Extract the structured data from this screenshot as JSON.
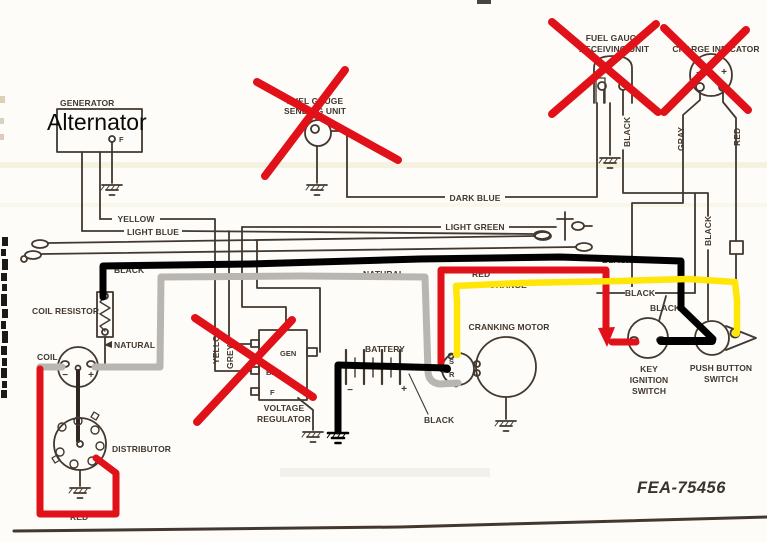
{
  "overlay_annotations": {
    "alternator_text": "Alternator",
    "cross_out_color": "#e01118",
    "wire_black": "#000000",
    "wire_red": "#e01118",
    "wire_yellow": "#ffe606",
    "wire_gray": "#b9b6b2"
  },
  "diagram": {
    "part_number": "FEA-75456",
    "ink_color": "#42382f",
    "components": {
      "generator": {
        "label": "GENERATOR",
        "terminal_f": "F"
      },
      "fuel_gauge_sending_unit": {
        "line1": "FUEL GAUGE",
        "line2": "SENDING UNIT"
      },
      "fuel_gauge_receiving_unit": {
        "line1": "FUEL GAUGE",
        "line2": "RECEIVING UNIT"
      },
      "charge_indicator": {
        "label": "CHARGE INDICATOR",
        "minus": "−",
        "plus": "+"
      },
      "coil_resistor": {
        "label": "COIL RESISTOR"
      },
      "coil": {
        "label": "COIL",
        "minus": "−",
        "plus": "+"
      },
      "distributor": {
        "label": "DISTRIBUTOR"
      },
      "voltage_regulator": {
        "line1": "VOLTAGE",
        "line2": "REGULATOR",
        "gen": "GEN",
        "bat": "BAT",
        "f": "F"
      },
      "battery": {
        "label": "BATTERY",
        "minus": "−",
        "plus": "+"
      },
      "cranking_motor": {
        "label": "CRANKING MOTOR",
        "s": "S",
        "r": "R"
      },
      "key_ignition_switch": {
        "line1": "KEY",
        "line2": "IGNITION",
        "line3": "SWITCH"
      },
      "push_button_switch": {
        "line1": "PUSH BUTTON",
        "line2": "SWITCH"
      }
    },
    "wire_labels": {
      "yellow": "YELLOW",
      "light_blue": "LIGHT BLUE",
      "dark_blue": "DARK BLUE",
      "light_green": "LIGHT GREEN",
      "natural_upper": "NATURAL",
      "natural_lower": "NATURAL",
      "natural_right": "NATURAL",
      "regulator_yellow": "YELLOW",
      "regulator_grey": "GREY",
      "receiving_unit_black": "BLACK",
      "charge_gray": "GRAY",
      "charge_red": "RED",
      "right_side_black": "BLACK",
      "bus_black_left": "BLACK",
      "bus_black_right": "BLACK",
      "bus_red": "RED",
      "bus_orange": "ORANGE",
      "key_switch_black_1": "BLACK",
      "key_switch_black_2": "BLACK",
      "battery_black": "BLACK",
      "distributor_red": "RED"
    }
  }
}
